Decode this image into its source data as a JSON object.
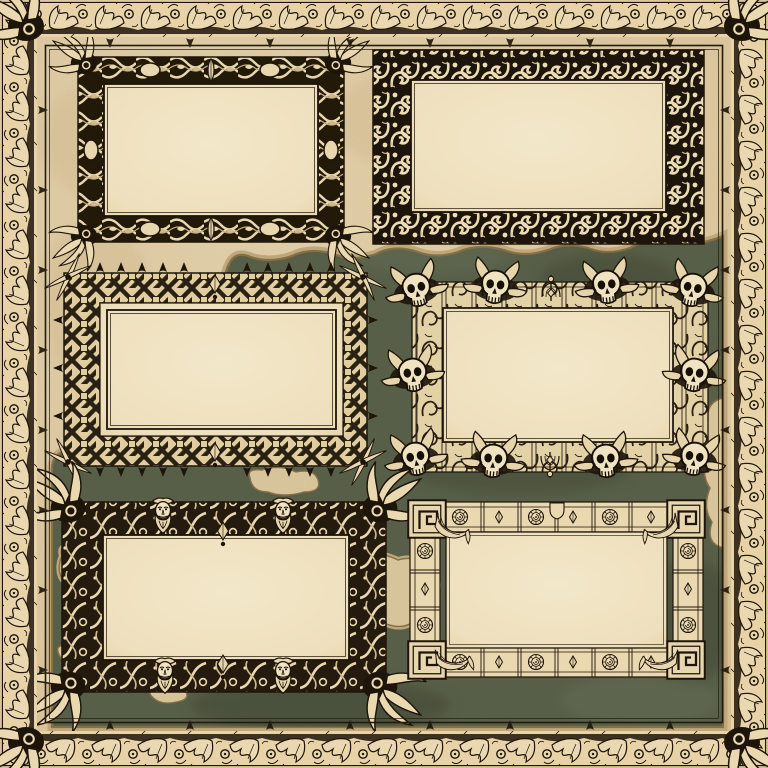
{
  "page": {
    "background_label": "Aged parchment map background with dark green sea and tan coastlines",
    "border_label": "Engraved acanthus-leaf page border with corner flourishes"
  },
  "palette": {
    "parchment": "#e8d2a7",
    "panel_cream": "#f2e6c8",
    "sea_green": "#57614b",
    "coast_brown": "#8d7346",
    "coast_sand": "#c9b183",
    "ink": "#1e150a"
  },
  "frames": [
    {
      "id": "twisted-vine",
      "label": "Twisted-branch frame with leaf-cluster corners, oval medallions and bud finials"
    },
    {
      "id": "foliate-scroll",
      "label": "Dense foliate scrollwork frame"
    },
    {
      "id": "interlaced-ribbon",
      "label": "Interlaced ribbon frame with thorn spikes and crossed-blade corners"
    },
    {
      "id": "skull-foliage",
      "label": "Skull and foliage frame with ten skulls and trellis band"
    },
    {
      "id": "bearded-mask",
      "label": "Art-nouveau frame with four bearded mask ornaments and leafy corners"
    },
    {
      "id": "architectural-panel",
      "label": "Architectural panel frame with Greek-key corners, rose medallions and corner drapery"
    }
  ],
  "ornament_icons": [
    "skull-icon",
    "bearded-mask-icon",
    "rose-icon",
    "greek-key-icon",
    "leaf-cluster-icon",
    "drapery-icon",
    "oval-medallion-icon",
    "thorn-spike-icon",
    "pendant-icon",
    "candelabra-icon"
  ]
}
